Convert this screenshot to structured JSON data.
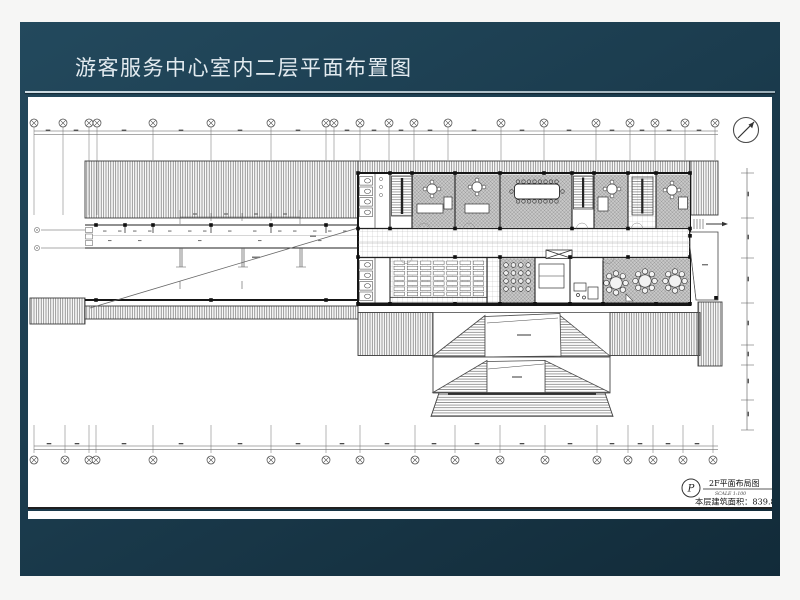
{
  "slide": {
    "title": "游客服务中心室内二层平面布置图"
  },
  "drawing": {
    "title_block": {
      "symbol": "P",
      "name": "2F平面布局图",
      "scale": "SCALE 1:100",
      "area_label": "本层建筑面积：839.8m²"
    }
  },
  "colors": {
    "slide_bg": "#1b3c4e",
    "divider": "#d6e4eb",
    "sheet": "#ffffff",
    "cad_line": "#333333"
  }
}
